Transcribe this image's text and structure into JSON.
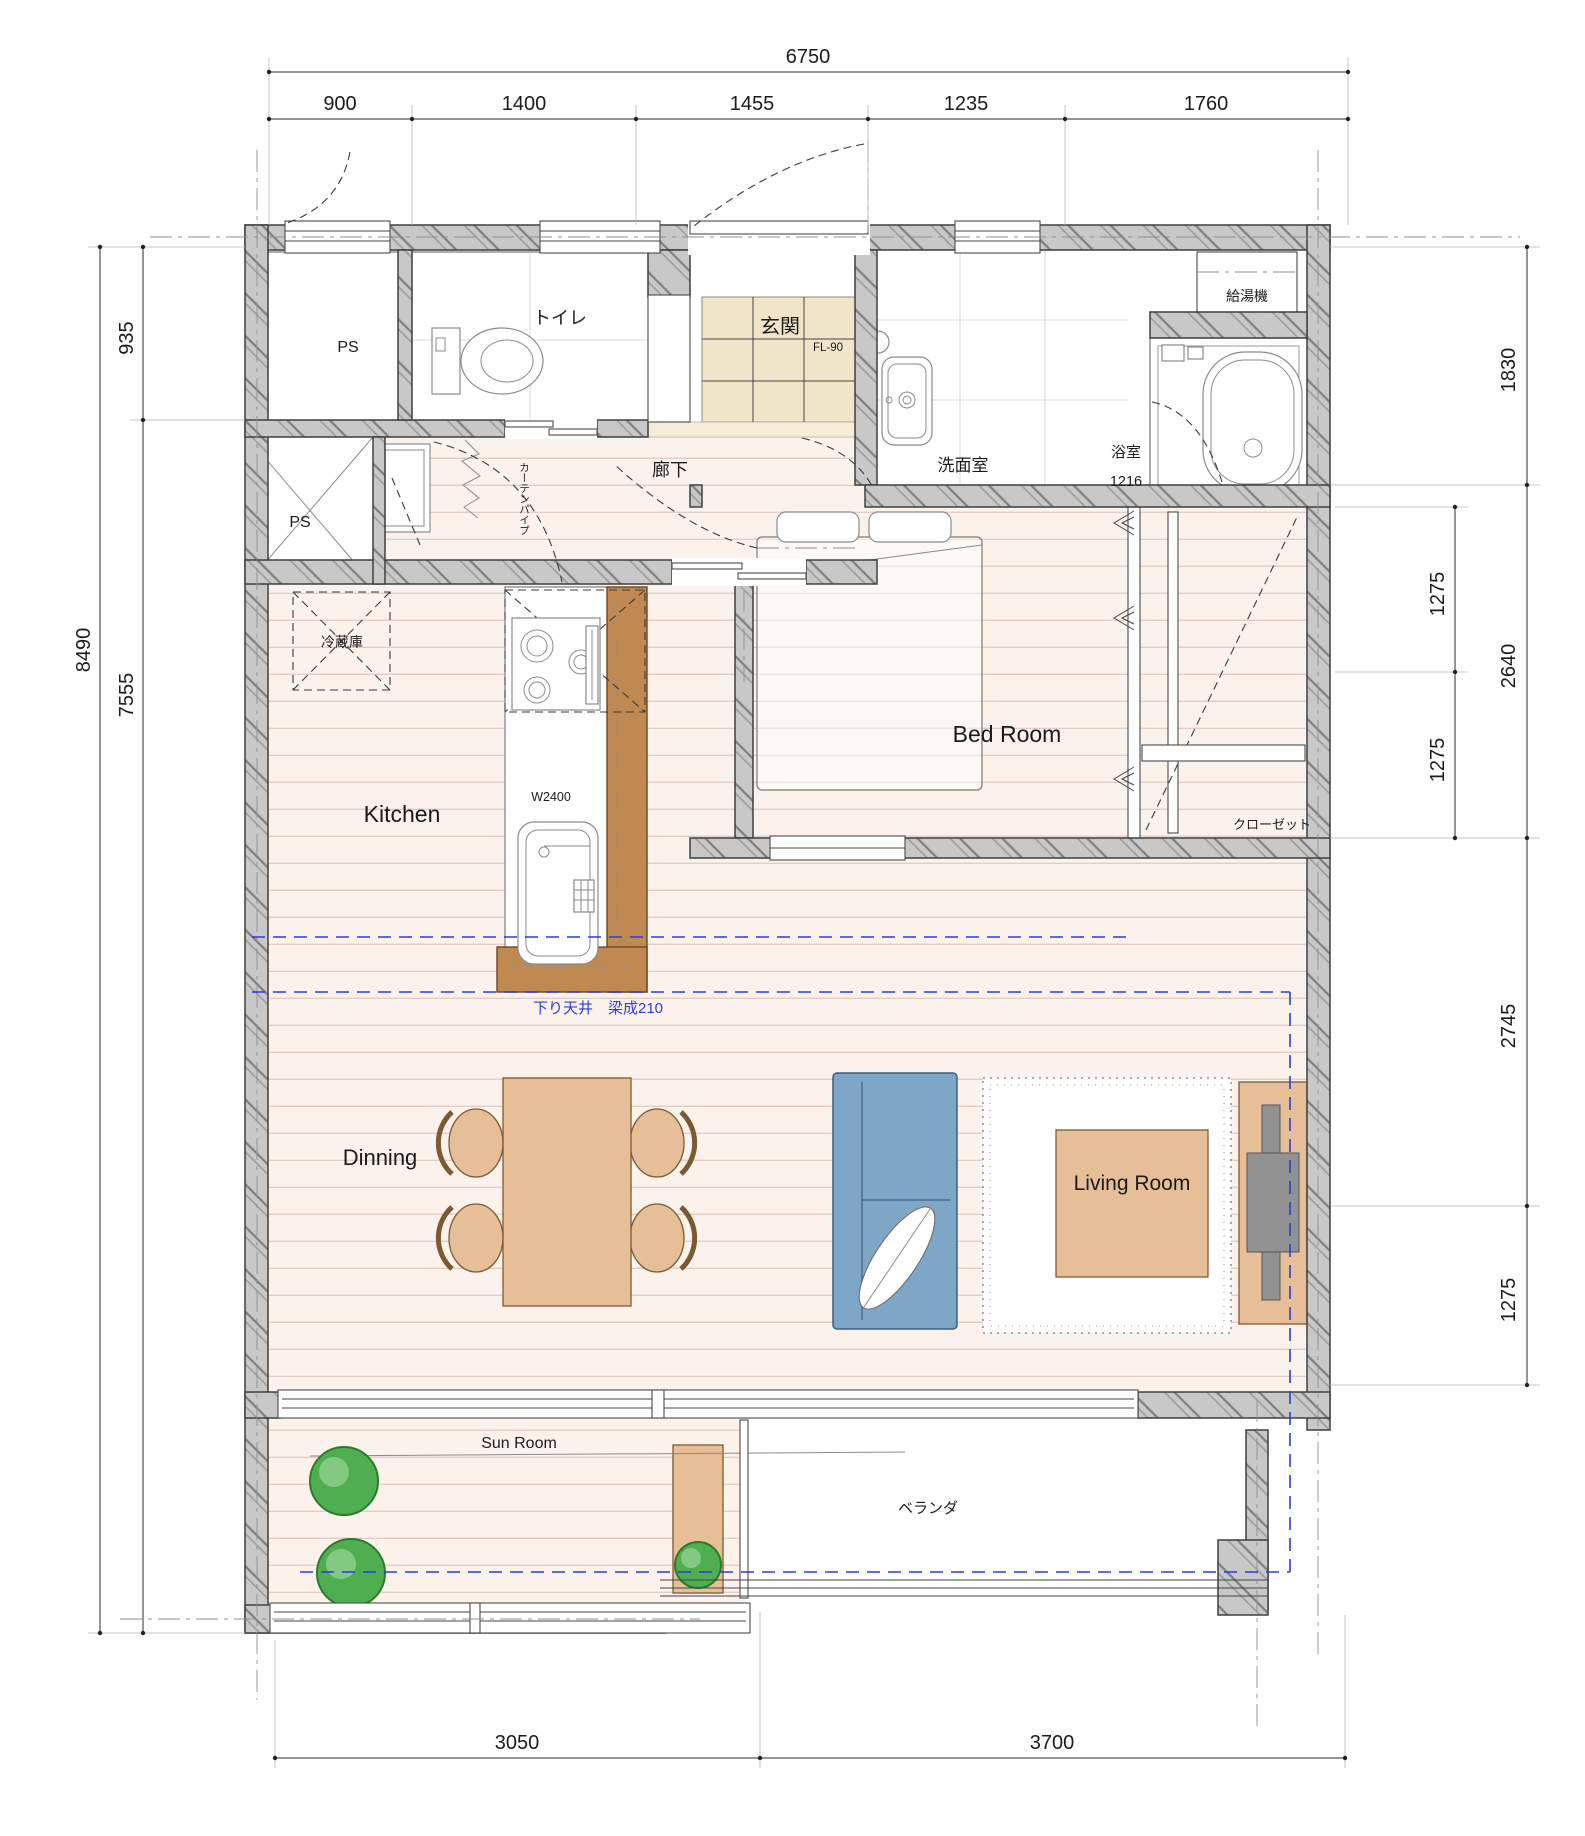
{
  "dimensions": {
    "top": {
      "overall": "6750",
      "segments": [
        "900",
        "1400",
        "1455",
        "1235",
        "1760"
      ]
    },
    "bottom": {
      "segments": [
        "3050",
        "3700"
      ]
    },
    "left": {
      "overall": "8490",
      "segments": [
        "935",
        "7555"
      ]
    },
    "right": {
      "outer_segments": [
        "1830",
        "2640",
        "2745",
        "1275"
      ],
      "inner_segments": [
        "1275",
        "1275"
      ]
    }
  },
  "rooms": {
    "ps_upper": "PS",
    "toilet": "トイレ",
    "entrance": "玄関",
    "washroom": "洗面室",
    "bathroom": "浴室",
    "water_heater": "給湯機",
    "corridor": "廊下",
    "ps_lower": "PS",
    "kitchen": "Kitchen",
    "bedroom": "Bed Room",
    "closet": "クローゼット",
    "dining": "Dinning",
    "living": "Living Room",
    "sunroom": "Sun Room",
    "veranda": "ベランダ"
  },
  "annotations": {
    "entrance_floor_level": "FL-90",
    "bathroom_size": "1216",
    "refrigerator": "冷蔵庫",
    "counter_width": "W2400",
    "curtain_pipe": "カーテンパイプ",
    "beam_note": "下り天井　梁成210"
  },
  "colors": {
    "wall": "#c8c8c8",
    "wood_floor": "#fbf2ec",
    "entrance_tile": "#f0e5c8",
    "counter": "#bf8951",
    "sofa": "#7ea6c7",
    "furniture": "#e6bf98",
    "plant": "#4fae4f",
    "beam_line": "#2b3cdb"
  }
}
